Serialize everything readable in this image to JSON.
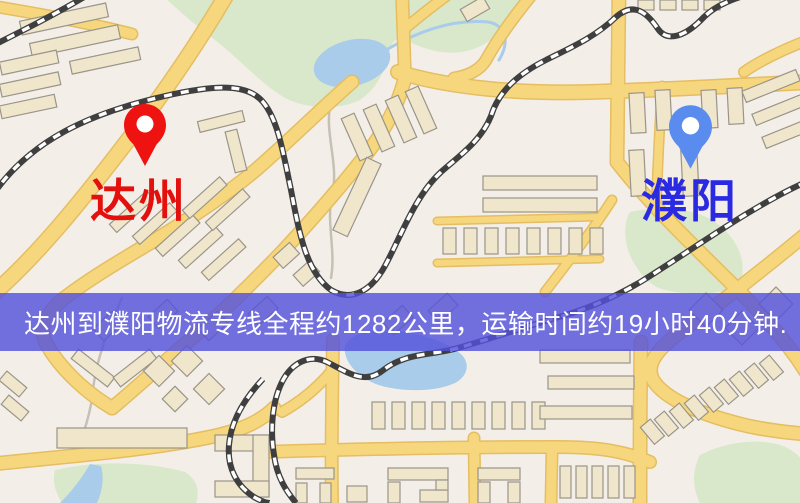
{
  "map": {
    "type": "road-map",
    "colors": {
      "background": "#f3efe8",
      "park": "#d9e8cb",
      "water": "#a8cce9",
      "road_fill": "#f7d77e",
      "road_casing": "#e5bd62",
      "railway": "#3f3f3f",
      "building_fill": "#efe6cc",
      "building_stroke": "#9a9489"
    }
  },
  "markers": {
    "origin": {
      "label": "达州",
      "label_color": "#e3100d",
      "pin_color": "#ee1211"
    },
    "destination": {
      "label": "濮阳",
      "label_color": "#2a2ae2",
      "pin_color": "#5a8bef"
    }
  },
  "route": {
    "origin": "达州",
    "destination": "濮阳",
    "distance_km": 1282,
    "duration": "19小时40分钟"
  },
  "banner": {
    "text": "达州到濮阳物流专线全程约1282公里，运输时间约19小时40分钟.",
    "background": "#5452DC",
    "overlay_alpha": 0.82,
    "text_color": "#ffffff"
  }
}
